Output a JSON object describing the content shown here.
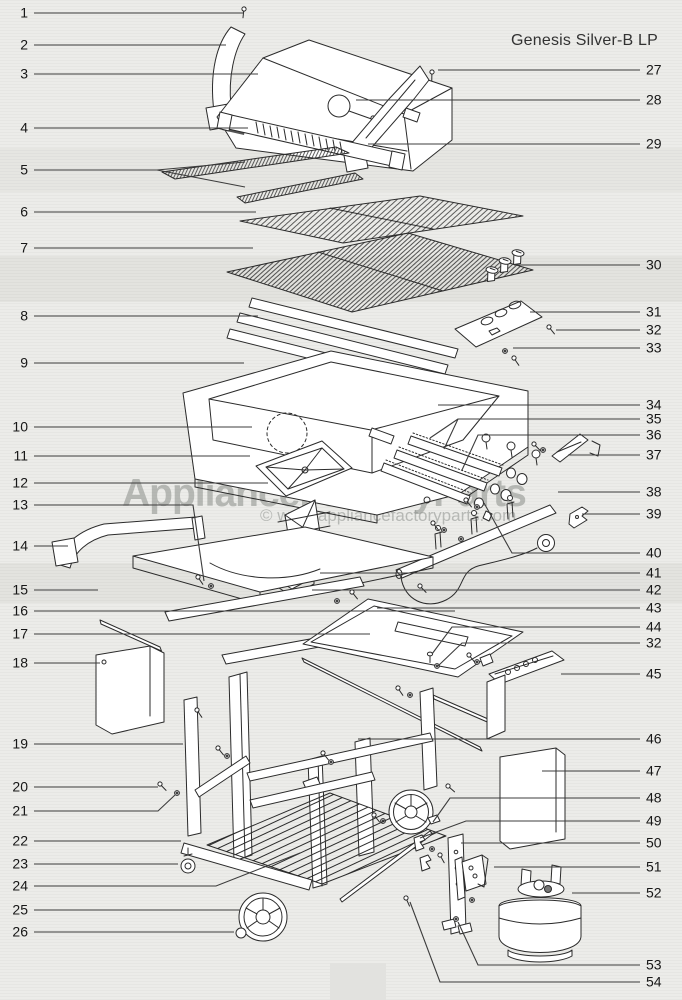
{
  "title": "Genesis Silver-B LP",
  "watermark": {
    "brand": "ApplianceFactoryParts",
    "copyright": "© www.appliancefactoryparts.com"
  },
  "callouts": [
    {
      "n": "1",
      "side": "L",
      "y": 13,
      "lines": [
        [
          [
            34,
            13
          ],
          [
            243,
            13
          ]
        ]
      ]
    },
    {
      "n": "2",
      "side": "L",
      "y": 45,
      "lines": [
        [
          [
            34,
            45
          ],
          [
            226,
            45
          ]
        ]
      ]
    },
    {
      "n": "3",
      "side": "L",
      "y": 74,
      "lines": [
        [
          [
            34,
            74
          ],
          [
            258,
            74
          ]
        ]
      ]
    },
    {
      "n": "4",
      "side": "L",
      "y": 128,
      "lines": [
        [
          [
            34,
            128
          ],
          [
            248,
            128
          ]
        ]
      ]
    },
    {
      "n": "5",
      "side": "L",
      "y": 170,
      "lines": [
        [
          [
            34,
            170
          ],
          [
            157,
            170
          ]
        ],
        [
          [
            157,
            170
          ],
          [
            245,
            162
          ]
        ],
        [
          [
            157,
            170
          ],
          [
            245,
            187
          ]
        ]
      ]
    },
    {
      "n": "6",
      "side": "L",
      "y": 212,
      "lines": [
        [
          [
            34,
            212
          ],
          [
            256,
            212
          ]
        ]
      ]
    },
    {
      "n": "7",
      "side": "L",
      "y": 248,
      "lines": [
        [
          [
            34,
            248
          ],
          [
            253,
            248
          ]
        ]
      ]
    },
    {
      "n": "8",
      "side": "L",
      "y": 316,
      "lines": [
        [
          [
            34,
            316
          ],
          [
            258,
            316
          ]
        ]
      ]
    },
    {
      "n": "9",
      "side": "L",
      "y": 363,
      "lines": [
        [
          [
            34,
            363
          ],
          [
            244,
            363
          ]
        ]
      ]
    },
    {
      "n": "10",
      "side": "L",
      "y": 427,
      "lines": [
        [
          [
            34,
            427
          ],
          [
            252,
            427
          ]
        ]
      ]
    },
    {
      "n": "11",
      "side": "L",
      "y": 456,
      "lines": [
        [
          [
            34,
            456
          ],
          [
            250,
            456
          ]
        ]
      ]
    },
    {
      "n": "12",
      "side": "L",
      "y": 483,
      "lines": [
        [
          [
            34,
            483
          ],
          [
            268,
            483
          ]
        ]
      ]
    },
    {
      "n": "13",
      "side": "L",
      "y": 505,
      "lines": [
        [
          [
            34,
            505
          ],
          [
            193,
            505
          ],
          [
            204,
            581
          ]
        ]
      ]
    },
    {
      "n": "14",
      "side": "L",
      "y": 546,
      "lines": [
        [
          [
            34,
            546
          ],
          [
            68,
            546
          ]
        ]
      ]
    },
    {
      "n": "15",
      "side": "L",
      "y": 590,
      "lines": [
        [
          [
            34,
            590
          ],
          [
            98,
            590
          ]
        ]
      ]
    },
    {
      "n": "16",
      "side": "L",
      "y": 611,
      "lines": [
        [
          [
            34,
            611
          ],
          [
            455,
            611
          ]
        ]
      ]
    },
    {
      "n": "17",
      "side": "L",
      "y": 634,
      "lines": [
        [
          [
            34,
            634
          ],
          [
            370,
            634
          ]
        ]
      ]
    },
    {
      "n": "18",
      "side": "L",
      "y": 663,
      "lines": [
        [
          [
            34,
            663
          ],
          [
            100,
            663
          ]
        ]
      ]
    },
    {
      "n": "19",
      "side": "L",
      "y": 744,
      "lines": [
        [
          [
            34,
            744
          ],
          [
            183,
            744
          ]
        ]
      ]
    },
    {
      "n": "20",
      "side": "L",
      "y": 787,
      "lines": [
        [
          [
            34,
            787
          ],
          [
            158,
            787
          ]
        ]
      ]
    },
    {
      "n": "21",
      "side": "L",
      "y": 811,
      "lines": [
        [
          [
            34,
            811
          ],
          [
            158,
            811
          ],
          [
            175,
            795
          ]
        ]
      ]
    },
    {
      "n": "22",
      "side": "L",
      "y": 841,
      "lines": [
        [
          [
            34,
            841
          ],
          [
            181,
            841
          ]
        ]
      ]
    },
    {
      "n": "23",
      "side": "L",
      "y": 864,
      "lines": [
        [
          [
            34,
            864
          ],
          [
            178,
            864
          ]
        ]
      ]
    },
    {
      "n": "24",
      "side": "L",
      "y": 886,
      "lines": [
        [
          [
            34,
            886
          ],
          [
            216,
            886
          ],
          [
            300,
            853
          ]
        ]
      ]
    },
    {
      "n": "25",
      "side": "L",
      "y": 910,
      "lines": [
        [
          [
            34,
            910
          ],
          [
            240,
            910
          ]
        ]
      ]
    },
    {
      "n": "26",
      "side": "L",
      "y": 932,
      "lines": [
        [
          [
            34,
            932
          ],
          [
            234,
            932
          ]
        ]
      ]
    },
    {
      "n": "27",
      "side": "R",
      "y": 70,
      "lines": [
        [
          [
            438,
            70
          ],
          [
            640,
            70
          ]
        ]
      ]
    },
    {
      "n": "28",
      "side": "R",
      "y": 100,
      "lines": [
        [
          [
            356,
            100
          ],
          [
            640,
            100
          ]
        ]
      ]
    },
    {
      "n": "29",
      "side": "R",
      "y": 144,
      "lines": [
        [
          [
            368,
            144
          ],
          [
            640,
            144
          ]
        ]
      ]
    },
    {
      "n": "30",
      "side": "R",
      "y": 265,
      "lines": [
        [
          [
            514,
            265
          ],
          [
            640,
            265
          ]
        ]
      ]
    },
    {
      "n": "31",
      "side": "R",
      "y": 312,
      "lines": [
        [
          [
            530,
            312
          ],
          [
            640,
            312
          ]
        ]
      ]
    },
    {
      "n": "32",
      "side": "R",
      "y": 330,
      "lines": [
        [
          [
            556,
            330
          ],
          [
            640,
            330
          ]
        ]
      ]
    },
    {
      "n": "33",
      "side": "R",
      "y": 348,
      "lines": [
        [
          [
            513,
            348
          ],
          [
            640,
            348
          ]
        ]
      ]
    },
    {
      "n": "34",
      "side": "R",
      "y": 405,
      "lines": [
        [
          [
            438,
            405
          ],
          [
            640,
            405
          ]
        ]
      ]
    },
    {
      "n": "35",
      "side": "R",
      "y": 419,
      "lines": [
        [
          [
            640,
            419
          ],
          [
            458,
            419
          ],
          [
            444,
            449
          ]
        ],
        [
          [
            458,
            419
          ],
          [
            430,
            438
          ]
        ]
      ]
    },
    {
      "n": "36",
      "side": "R",
      "y": 435,
      "lines": [
        [
          [
            640,
            435
          ],
          [
            478,
            435
          ],
          [
            462,
            470
          ]
        ]
      ]
    },
    {
      "n": "37",
      "side": "R",
      "y": 455,
      "lines": [
        [
          [
            568,
            455
          ],
          [
            640,
            455
          ]
        ]
      ]
    },
    {
      "n": "38",
      "side": "R",
      "y": 492,
      "lines": [
        [
          [
            558,
            492
          ],
          [
            640,
            492
          ]
        ]
      ]
    },
    {
      "n": "39",
      "side": "R",
      "y": 514,
      "lines": [
        [
          [
            582,
            514
          ],
          [
            640,
            514
          ]
        ]
      ]
    },
    {
      "n": "40",
      "side": "R",
      "y": 553,
      "lines": [
        [
          [
            640,
            553
          ],
          [
            512,
            553
          ],
          [
            484,
            503
          ]
        ]
      ]
    },
    {
      "n": "41",
      "side": "R",
      "y": 573,
      "lines": [
        [
          [
            320,
            573
          ],
          [
            640,
            573
          ]
        ]
      ]
    },
    {
      "n": "42",
      "side": "R",
      "y": 590,
      "lines": [
        [
          [
            312,
            590
          ],
          [
            640,
            590
          ]
        ]
      ]
    },
    {
      "n": "43",
      "side": "R",
      "y": 608,
      "lines": [
        [
          [
            377,
            608
          ],
          [
            640,
            608
          ]
        ]
      ]
    },
    {
      "n": "44",
      "side": "R",
      "y": 627,
      "lines": [
        [
          [
            640,
            627
          ],
          [
            452,
            627
          ],
          [
            432,
            654
          ]
        ]
      ]
    },
    {
      "n": "32",
      "side": "R",
      "y": 643,
      "lines": [
        [
          [
            640,
            643
          ],
          [
            462,
            643
          ],
          [
            438,
            666
          ]
        ]
      ]
    },
    {
      "n": "45",
      "side": "R",
      "y": 674,
      "lines": [
        [
          [
            561,
            674
          ],
          [
            640,
            674
          ]
        ]
      ]
    },
    {
      "n": "46",
      "side": "R",
      "y": 739,
      "lines": [
        [
          [
            358,
            739
          ],
          [
            640,
            739
          ]
        ]
      ]
    },
    {
      "n": "47",
      "side": "R",
      "y": 771,
      "lines": [
        [
          [
            542,
            771
          ],
          [
            640,
            771
          ]
        ]
      ]
    },
    {
      "n": "48",
      "side": "R",
      "y": 798,
      "lines": [
        [
          [
            640,
            798
          ],
          [
            450,
            798
          ],
          [
            433,
            822
          ]
        ]
      ]
    },
    {
      "n": "49",
      "side": "R",
      "y": 821,
      "lines": [
        [
          [
            640,
            821
          ],
          [
            466,
            821
          ],
          [
            420,
            838
          ]
        ]
      ]
    },
    {
      "n": "50",
      "side": "R",
      "y": 843,
      "lines": [
        [
          [
            461,
            843
          ],
          [
            640,
            843
          ]
        ]
      ]
    },
    {
      "n": "51",
      "side": "R",
      "y": 867,
      "lines": [
        [
          [
            494,
            867
          ],
          [
            640,
            867
          ]
        ]
      ]
    },
    {
      "n": "52",
      "side": "R",
      "y": 893,
      "lines": [
        [
          [
            572,
            893
          ],
          [
            640,
            893
          ]
        ]
      ]
    },
    {
      "n": "53",
      "side": "R",
      "y": 965,
      "lines": [
        [
          [
            640,
            965
          ],
          [
            478,
            965
          ],
          [
            458,
            922
          ]
        ]
      ]
    },
    {
      "n": "54",
      "side": "R",
      "y": 982,
      "lines": [
        [
          [
            640,
            982
          ],
          [
            440,
            982
          ],
          [
            410,
            902
          ]
        ]
      ]
    }
  ]
}
